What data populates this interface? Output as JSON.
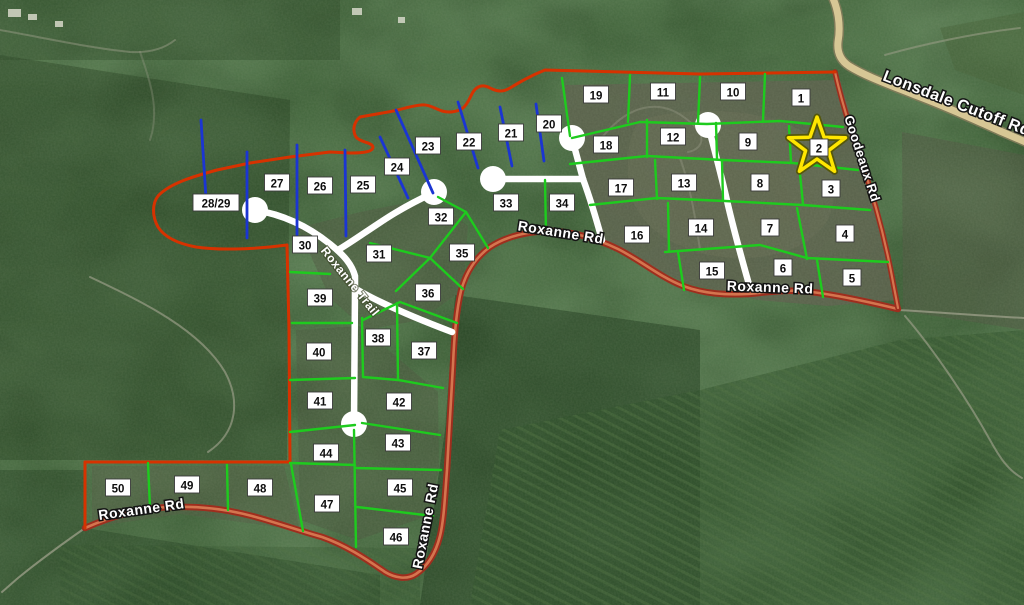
{
  "map": {
    "width": 1024,
    "height": 605,
    "colors": {
      "forest_base": "#2c4a27",
      "boundary_red": "#d63200",
      "road_red_casing": "#9e2e1e",
      "road_red_center": "#d4754f",
      "lot_green": "#1ecb1e",
      "lot_blue": "#1b35d2",
      "road_white": "#ffffff",
      "road_tan": "#d7c795",
      "road_tan_casing": "#7d7a58",
      "trail_gray": "#989c86",
      "label_bg": "#ffffff",
      "label_border": "#3a3a3a",
      "label_text": "#0d0d0d",
      "star_yellow": "#ffe600",
      "star_edge": "#55570a",
      "building": "#cfd2c2"
    },
    "lots": [
      {
        "n": "1",
        "x": 801,
        "y": 98
      },
      {
        "n": "2",
        "x": 819,
        "y": 148
      },
      {
        "n": "3",
        "x": 831,
        "y": 189
      },
      {
        "n": "4",
        "x": 845,
        "y": 234
      },
      {
        "n": "5",
        "x": 852,
        "y": 278
      },
      {
        "n": "6",
        "x": 783,
        "y": 268
      },
      {
        "n": "7",
        "x": 770,
        "y": 228
      },
      {
        "n": "8",
        "x": 760,
        "y": 183
      },
      {
        "n": "9",
        "x": 748,
        "y": 142
      },
      {
        "n": "10",
        "x": 733,
        "y": 92
      },
      {
        "n": "11",
        "x": 663,
        "y": 92
      },
      {
        "n": "12",
        "x": 673,
        "y": 137
      },
      {
        "n": "13",
        "x": 684,
        "y": 183
      },
      {
        "n": "14",
        "x": 701,
        "y": 228
      },
      {
        "n": "15",
        "x": 712,
        "y": 271
      },
      {
        "n": "16",
        "x": 637,
        "y": 235
      },
      {
        "n": "17",
        "x": 621,
        "y": 188
      },
      {
        "n": "18",
        "x": 606,
        "y": 145
      },
      {
        "n": "19",
        "x": 596,
        "y": 95
      },
      {
        "n": "20",
        "x": 549,
        "y": 124
      },
      {
        "n": "21",
        "x": 511,
        "y": 133
      },
      {
        "n": "22",
        "x": 469,
        "y": 142
      },
      {
        "n": "23",
        "x": 428,
        "y": 146
      },
      {
        "n": "24",
        "x": 397,
        "y": 167
      },
      {
        "n": "25",
        "x": 363,
        "y": 185
      },
      {
        "n": "26",
        "x": 320,
        "y": 186
      },
      {
        "n": "27",
        "x": 277,
        "y": 183
      },
      {
        "n": "28/29",
        "x": 216,
        "y": 203
      },
      {
        "n": "30",
        "x": 305,
        "y": 245
      },
      {
        "n": "31",
        "x": 379,
        "y": 254
      },
      {
        "n": "32",
        "x": 441,
        "y": 217
      },
      {
        "n": "33",
        "x": 506,
        "y": 203
      },
      {
        "n": "34",
        "x": 562,
        "y": 203
      },
      {
        "n": "35",
        "x": 462,
        "y": 253
      },
      {
        "n": "36",
        "x": 428,
        "y": 293
      },
      {
        "n": "37",
        "x": 424,
        "y": 351
      },
      {
        "n": "38",
        "x": 378,
        "y": 338
      },
      {
        "n": "39",
        "x": 320,
        "y": 298
      },
      {
        "n": "40",
        "x": 319,
        "y": 352
      },
      {
        "n": "41",
        "x": 320,
        "y": 401
      },
      {
        "n": "42",
        "x": 399,
        "y": 402
      },
      {
        "n": "43",
        "x": 398,
        "y": 443
      },
      {
        "n": "44",
        "x": 326,
        "y": 453
      },
      {
        "n": "45",
        "x": 400,
        "y": 488
      },
      {
        "n": "46",
        "x": 396,
        "y": 537
      },
      {
        "n": "47",
        "x": 327,
        "y": 504
      },
      {
        "n": "48",
        "x": 260,
        "y": 488
      },
      {
        "n": "49",
        "x": 187,
        "y": 485
      },
      {
        "n": "50",
        "x": 118,
        "y": 488
      }
    ],
    "star": {
      "marks_lot": "2",
      "points": "817,117 824.1,137.3 845.5,137.7 828.4,150.7 834.6,171.3 817,159 799.4,171.3 805.6,150.7 788.5,137.7 809.9,137.3"
    },
    "road_labels": [
      {
        "text": "Lonsdale Cutoff Rd",
        "x": 955,
        "y": 108,
        "rot": 21,
        "size": 16,
        "variant": "outline"
      },
      {
        "text": "Goodeaux Rd",
        "x": 858,
        "y": 160,
        "rot": 72,
        "size": 13,
        "variant": "outline"
      },
      {
        "text": "Roxanne Rd",
        "x": 560,
        "y": 237,
        "rot": 9,
        "size": 14,
        "variant": "outline"
      },
      {
        "text": "Roxanne Rd",
        "x": 770,
        "y": 292,
        "rot": 2,
        "size": 14,
        "variant": "outline"
      },
      {
        "text": "Roxanne Rd",
        "x": 142,
        "y": 514,
        "rot": -8,
        "size": 14,
        "variant": "outline"
      },
      {
        "text": "Roxanne Rd",
        "x": 430,
        "y": 527,
        "rot": -79,
        "size": 14,
        "variant": "outline"
      },
      {
        "text": "Roxanne Trail",
        "x": 347,
        "y": 284,
        "rot": 51,
        "size": 12,
        "variant": "trail"
      }
    ],
    "boundary_paths": [
      "M835,72 L700,74 L545,70 C530,76 520,82 510,88 C503,92 498,92 490,88 C483,84 477,86 473,92 C470,97 468,104 463,108 C457,112 449,113 442,111 C434,108 428,104 421,105 C410,106 400,110 388,112 L360,117 C354,122 352,130 356,137 C361,143 372,142 373,147 C373,152 362,153 350,153 L330,152 L290,157 L250,163 L217,170 C195,176 170,183 158,196 C152,204 152,216 158,227 C165,238 180,244 196,247 C215,250 250,250 287,245",
      "M287,245 L289,330 L290,462",
      "M290,462 L85,462",
      "M85,462 L85,528"
    ],
    "goodeaux_path": "M835,72 C839,90 845,112 853,136 C861,160 869,183 876,208 C883,233 889,260 893,282 L898,308",
    "roxanne_road_path": "M85,528 C110,517 140,508 170,507 C200,506 225,509 252,516 C278,523 300,531 322,537 C345,545 365,558 385,572 C395,578 407,580 416,574 C428,566 436,552 440,536 C444,520 445,495 447,470 C449,435 451,400 453,365 C454,340 456,312 461,291 C466,272 475,258 490,247 C505,237 525,232 548,231 C572,231 595,238 618,249 C640,260 660,277 683,286 C705,294 725,295 748,294 C770,292 790,289 812,292 C835,295 865,301 898,309",
    "lonsdale_road_path": "M831,-6 C838,8 841,25 838,42 C837,52 840,60 849,66 C865,76 890,85 915,95 C945,106 975,120 1000,131 L1028,143",
    "white_roads": {
      "width": 6.5,
      "bulb_r": 13,
      "paths": [
        "M255,210 C280,214 305,224 330,244 C345,256 352,265 355,276 L355,288 L354,424",
        "M338,250 C355,240 375,225 395,213 C410,204 422,198 433,193",
        "M356,289 C380,303 415,318 452,332",
        "M493,179 L583,179",
        "M583,179 L573,142",
        "M583,179 C590,198 596,218 602,240",
        "M708,125 C715,152 722,178 728,205 C735,235 743,263 750,288"
      ],
      "culdesacs": [
        [
          255,
          210
        ],
        [
          434,
          192
        ],
        [
          354,
          424
        ],
        [
          493,
          179
        ],
        [
          572,
          138
        ],
        [
          708,
          125
        ]
      ]
    },
    "green_paths": [
      "M572,138 L640,122 L707,124 L780,121 L843,127",
      "M630,75 L628,122",
      "M700,77 L698,123",
      "M765,74 L763,121",
      "M562,78 L570,136",
      "M570,164 L647,156 L723,160 L793,163 L858,170",
      "M647,120 L647,157",
      "M716,123 L717,159",
      "M789,126 L791,162",
      "M590,205 L657,198 L725,201 L803,205 L870,210",
      "M655,160 L657,199",
      "M722,161 L723,200",
      "M799,164 L803,204",
      "M665,252 L760,245 L807,258 L888,262",
      "M668,203 L669,250",
      "M797,208 L807,259",
      "M678,252 L684,290",
      "M817,260 L823,297",
      "M545,180 L546,233",
      "M290,272 L330,274",
      "M292,323 L352,323",
      "M290,380 L355,378",
      "M290,432 L355,425",
      "M290,463 L355,465",
      "M354,430 L356,547",
      "M355,468 L441,470",
      "M357,507 L433,516",
      "M362,318 L363,377",
      "M363,377 L398,380 L443,388",
      "M362,423 L440,435",
      "M397,303 L398,380",
      "M363,320 L400,302 L457,323",
      "M370,243 L430,258 L463,289",
      "M466,212 L430,258 L396,291",
      "M438,197 L466,212 L488,248",
      "M291,464 L303,531",
      "M227,465 L228,510",
      "M148,463 L150,508"
    ],
    "blue_paths": [
      "M201,120 L206,198",
      "M247,152 L247,238",
      "M297,145 L297,235",
      "M345,150 L346,236",
      "M380,137 L408,198",
      "M396,110 L433,193",
      "M458,102 L478,168",
      "M500,107 L512,166",
      "M536,104 L544,161"
    ],
    "terrain": {
      "clearings": [
        {
          "d": "M565,85 L840,80 L856,132 L880,222 L896,300 L828,306 L758,300 L688,284 L636,260 L598,238 L582,185 L568,128 Z",
          "fill": "#5a604b",
          "op": 0.88
        },
        {
          "d": "M640,120 C690,105 760,108 800,130 C830,148 840,185 830,215 C815,250 760,265 710,255 C660,245 630,215 628,180 C627,150 630,132 640,120 Z",
          "fill": "#686e56",
          "op": 0.4
        },
        {
          "d": "M298,228 L360,212 L432,198 L468,226 L463,290 L420,320 L366,330 L330,298 Z",
          "fill": "#4d5540",
          "op": 0.5
        },
        {
          "d": "M296,330 L360,326 L438,392 L439,470 L428,516 L358,540 L300,520 Z",
          "fill": "#4a523c",
          "op": 0.45
        },
        {
          "d": "M92,466 L284,466 L300,530 L180,514 L92,527 Z",
          "fill": "#515843",
          "op": 0.45
        },
        {
          "d": "M902,132 L1024,155 L1024,330 L903,311 Z",
          "fill": "#4e5641",
          "op": 0.55
        },
        {
          "d": "M940,28 L1024,12 L1024,95 L955,70 Z",
          "fill": "#436036",
          "op": 0.5
        }
      ],
      "shades": [
        {
          "d": "M0,55 L290,100 L287,460 L0,460 Z",
          "fill": "#203a1c",
          "op": 0.4
        },
        {
          "d": "M455,295 L700,330 L700,605 L420,605 L445,430 Z",
          "fill": "#1e381b",
          "op": 0.5
        },
        {
          "d": "M0,470 L85,470 L85,528 L380,575 L380,605 L0,605 Z",
          "fill": "#213d1e",
          "op": 0.4
        },
        {
          "d": "M0,0 L340,0 L340,60 L0,60 Z",
          "fill": "#2a4526",
          "op": 0.4
        }
      ],
      "plantations": [
        {
          "d": "M500,430 L700,390 L900,340 L1024,330 L1024,605 L470,605 Z",
          "base_op": 0.5,
          "rows_op": 0.45
        },
        {
          "d": "M60,545 L420,548 L420,605 L60,605 Z",
          "base_op": 0.3,
          "rows_op": 0.28
        }
      ],
      "trails": [
        {
          "d": "M85,528 C65,542 40,560 18,578 L2,592",
          "op": 0.8
        },
        {
          "d": "M90,277 C145,303 200,330 225,372 C240,400 238,432 208,452",
          "op": 0.7
        },
        {
          "d": "M898,310 C935,312 970,315 1024,318",
          "op": 0.8
        },
        {
          "d": "M905,316 C930,345 965,395 990,440 C1000,458 1008,470 1022,478",
          "op": 0.7
        },
        {
          "d": "M598,143 C625,105 660,95 690,122 C710,138 700,150 688,152",
          "op": 0.4
        },
        {
          "d": "M680,158 C690,185 695,215 700,250",
          "op": 0.4
        },
        {
          "d": "M0,30 C45,38 90,48 130,52 C150,53 165,48 175,40",
          "op": 0.5
        },
        {
          "d": "M885,55 C920,45 975,33 1020,28",
          "op": 0.6
        },
        {
          "d": "M140,52 C150,80 160,110 150,140",
          "op": 0.35
        }
      ],
      "buildings": [
        {
          "x": 8,
          "y": 9,
          "w": 13,
          "h": 8
        },
        {
          "x": 28,
          "y": 14,
          "w": 9,
          "h": 6
        },
        {
          "x": 55,
          "y": 21,
          "w": 8,
          "h": 6
        },
        {
          "x": 352,
          "y": 8,
          "w": 10,
          "h": 7
        },
        {
          "x": 398,
          "y": 17,
          "w": 7,
          "h": 6
        }
      ]
    }
  }
}
